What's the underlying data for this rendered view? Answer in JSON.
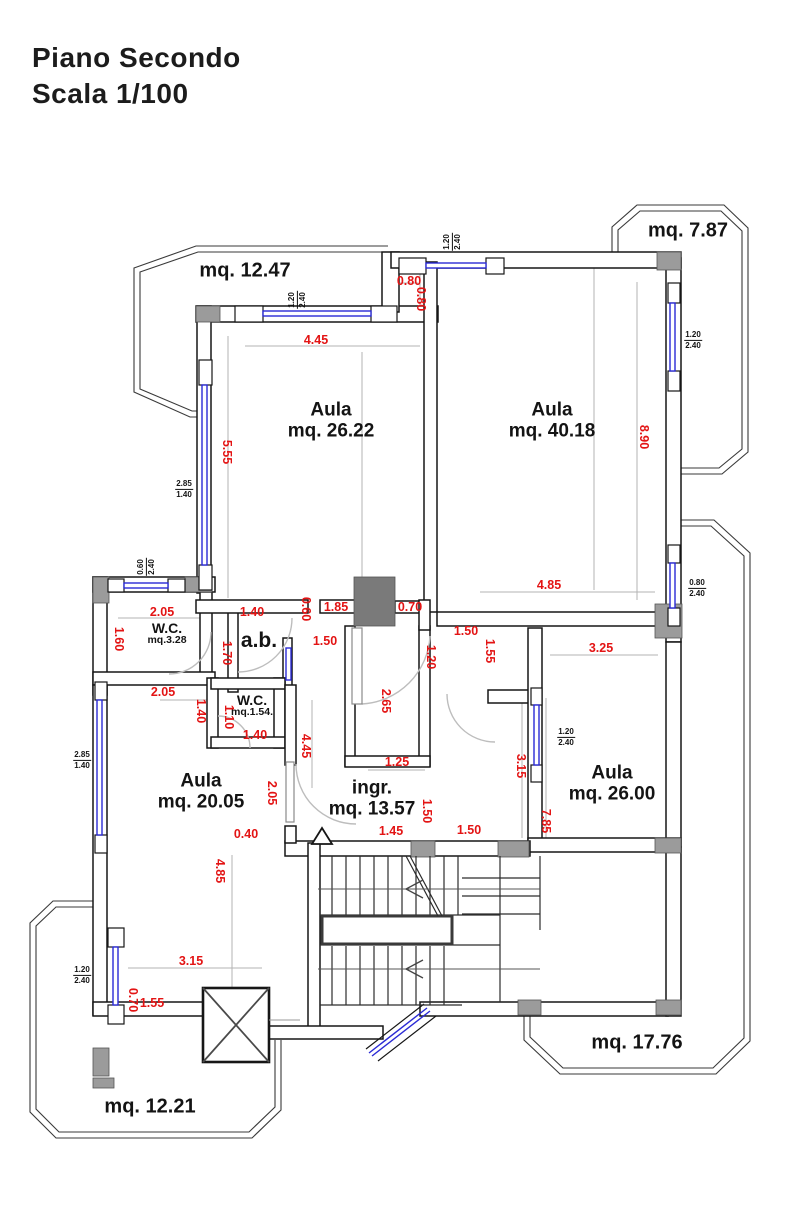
{
  "title": {
    "line1": "Piano Secondo",
    "line2": "Scala 1/100"
  },
  "colors": {
    "dimension_red": "#e31414",
    "window_blue": "#2b2bd5",
    "pillar_gray": "#9b9b9b",
    "wall_black": "#161616"
  },
  "labels": {
    "rooms": [
      {
        "name": "room-label-aula-26-22",
        "l1": "Aula",
        "l2": "mq. 26.22",
        "x": 331,
        "y": 421
      },
      {
        "name": "room-label-aula-40-18",
        "l1": "Aula",
        "l2": "mq. 40.18",
        "x": 552,
        "y": 421
      },
      {
        "name": "room-label-aula-20-05",
        "l1": "Aula",
        "l2": "mq. 20.05",
        "x": 201,
        "y": 792
      },
      {
        "name": "room-label-aula-26-00",
        "l1": "Aula",
        "l2": "mq. 26.00",
        "x": 612,
        "y": 784
      },
      {
        "name": "room-label-ingresso",
        "l1": "ingr.",
        "l2": "mq. 13.57",
        "x": 372,
        "y": 799
      },
      {
        "name": "room-label-wc-1",
        "cls": "sm",
        "l1": "W.C.",
        "l2": "mq.3.28",
        "x": 167,
        "y": 634
      },
      {
        "name": "room-label-wc-2",
        "cls": "sm",
        "l1": "W.C.",
        "l2": "mq.1.54.",
        "x": 252,
        "y": 706
      },
      {
        "name": "room-label-ab",
        "cls": "ab",
        "t": "a.b.",
        "x": 259,
        "y": 641
      }
    ],
    "zones": [
      {
        "name": "balcony-label-12-47",
        "t": "mq. 12.47",
        "x": 245,
        "y": 271
      },
      {
        "name": "balcony-label-7-87",
        "t": "mq. 7.87",
        "x": 688,
        "y": 231
      },
      {
        "name": "balcony-label-17-76",
        "t": "mq. 17.76",
        "x": 637,
        "y": 1043
      },
      {
        "name": "balcony-label-12-21",
        "t": "mq. 12.21",
        "x": 150,
        "y": 1107
      }
    ],
    "dims_h": [
      {
        "t": "0.80",
        "x": 409,
        "y": 281
      },
      {
        "t": "4.45",
        "x": 316,
        "y": 340
      },
      {
        "t": "2.05",
        "x": 162,
        "y": 612
      },
      {
        "t": "1.40",
        "x": 252,
        "y": 612
      },
      {
        "t": "1.85",
        "x": 336,
        "y": 607
      },
      {
        "t": "0.70",
        "x": 410,
        "y": 607
      },
      {
        "t": "4.85",
        "x": 549,
        "y": 585
      },
      {
        "t": "1.50",
        "x": 325,
        "y": 641
      },
      {
        "t": "1.50",
        "x": 466,
        "y": 631
      },
      {
        "t": "3.25",
        "x": 601,
        "y": 648
      },
      {
        "t": "2.05",
        "x": 163,
        "y": 692
      },
      {
        "t": "1.40",
        "x": 255,
        "y": 735
      },
      {
        "t": "1.25",
        "x": 397,
        "y": 762
      },
      {
        "t": "0.40",
        "x": 246,
        "y": 834
      },
      {
        "t": "1.45",
        "x": 391,
        "y": 831
      },
      {
        "t": "1.50",
        "x": 469,
        "y": 830
      },
      {
        "t": "3.15",
        "x": 191,
        "y": 961
      },
      {
        "t": "1.55",
        "x": 152,
        "y": 1003
      }
    ],
    "dims_v": [
      {
        "t": "0.80",
        "x": 421,
        "y": 299
      },
      {
        "t": "5.55",
        "x": 227,
        "y": 452
      },
      {
        "t": "8.90",
        "x": 644,
        "y": 437
      },
      {
        "t": "1.60",
        "x": 119,
        "y": 639
      },
      {
        "t": "0.60",
        "x": 306,
        "y": 609
      },
      {
        "t": "1.70",
        "x": 227,
        "y": 653
      },
      {
        "t": "1.20",
        "x": 431,
        "y": 657
      },
      {
        "t": "1.55",
        "x": 490,
        "y": 651
      },
      {
        "t": "1.40",
        "x": 201,
        "y": 711
      },
      {
        "t": "1.10",
        "x": 229,
        "y": 717
      },
      {
        "t": "4.45",
        "x": 306,
        "y": 746
      },
      {
        "t": "2.65",
        "x": 386,
        "y": 701
      },
      {
        "t": "2.05",
        "x": 272,
        "y": 793
      },
      {
        "t": "4.85",
        "x": 220,
        "y": 871
      },
      {
        "t": "1.50",
        "x": 427,
        "y": 811
      },
      {
        "t": "3.15",
        "x": 521,
        "y": 766
      },
      {
        "t": "7.85",
        "x": 546,
        "y": 821
      },
      {
        "t": "0.70",
        "x": 133,
        "y": 1000
      }
    ],
    "tags": [
      {
        "name": "window-tag",
        "l1": "1.20",
        "l2": "2.40",
        "x": 297,
        "y": 300,
        "rot": true
      },
      {
        "name": "window-tag",
        "l1": "1.20",
        "l2": "2.40",
        "x": 452,
        "y": 242,
        "rot": true
      },
      {
        "name": "window-tag",
        "l1": "1.20",
        "l2": "2.40",
        "x": 693,
        "y": 340
      },
      {
        "name": "window-tag",
        "l1": "0.80",
        "l2": "2.40",
        "x": 697,
        "y": 588
      },
      {
        "name": "window-tag",
        "l1": "0.60",
        "l2": "2.40",
        "x": 146,
        "y": 567,
        "rot": true
      },
      {
        "name": "window-tag",
        "l1": "2.85",
        "l2": "1.40",
        "x": 184,
        "y": 489
      },
      {
        "name": "window-tag",
        "l1": "2.85",
        "l2": "1.40",
        "x": 82,
        "y": 760
      },
      {
        "name": "window-tag",
        "l1": "1.20",
        "l2": "2.40",
        "x": 566,
        "y": 737
      },
      {
        "name": "window-tag",
        "l1": "1.20",
        "l2": "2.40",
        "x": 82,
        "y": 975
      }
    ]
  }
}
